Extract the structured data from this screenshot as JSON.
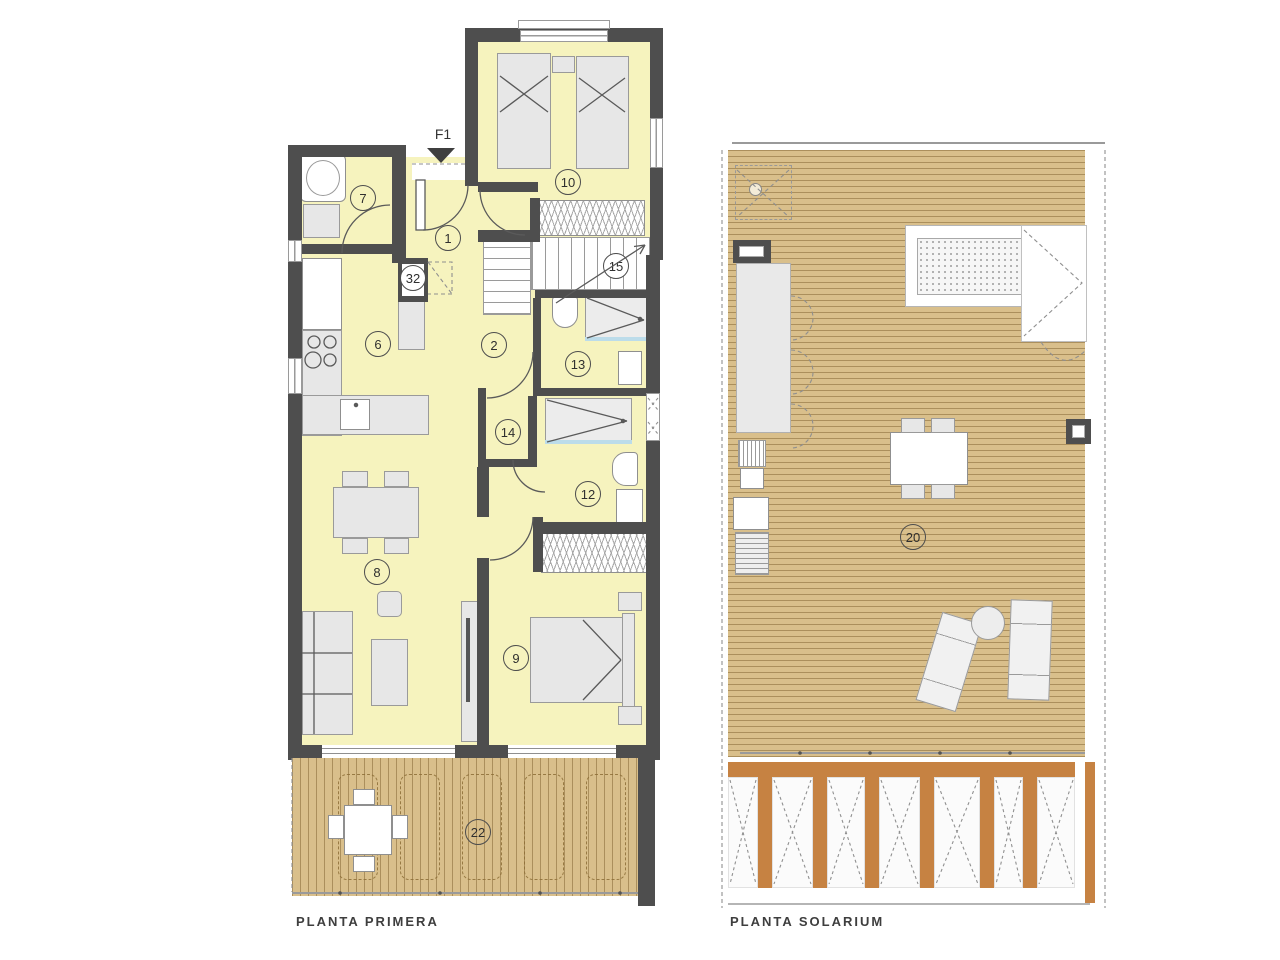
{
  "colors": {
    "wall": "#4E4E4E",
    "floor": "#F6F3BE",
    "deck": "#D9BF8B",
    "pergola": "#C68242",
    "labelColor": "#3E3E3E"
  },
  "plans": [
    {
      "label": "PLANTA PRIMERA",
      "entry_label": "F1",
      "rooms": [
        {
          "number": "7"
        },
        {
          "number": "1"
        },
        {
          "number": "10"
        },
        {
          "number": "32"
        },
        {
          "number": "15"
        },
        {
          "number": "6"
        },
        {
          "number": "2"
        },
        {
          "number": "13"
        },
        {
          "number": "14"
        },
        {
          "number": "12"
        },
        {
          "number": "8"
        },
        {
          "number": "9"
        },
        {
          "number": "22"
        }
      ]
    },
    {
      "label": "PLANTA SOLARIUM",
      "rooms": [
        {
          "number": "20"
        }
      ]
    }
  ]
}
